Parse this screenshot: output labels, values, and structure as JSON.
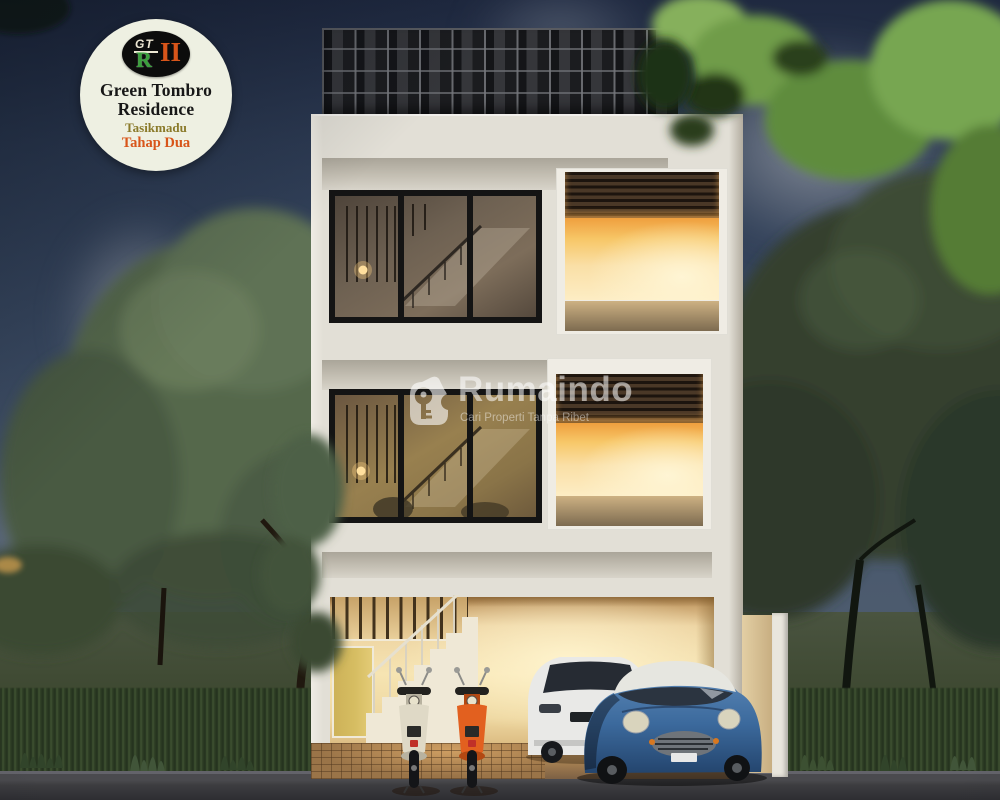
{
  "badge": {
    "logo_top": "GT",
    "logo_main": "R",
    "logo_numeral": "II",
    "title_line1": "Green Tombro",
    "title_line2": "Residence",
    "location": "Tasikmadu",
    "phase": "Tahap Dua"
  },
  "watermark": {
    "brand": "Rumaindo",
    "tagline": "Cari Properti Tanpa Ribet"
  },
  "palette": {
    "sky_top": "#1f2940",
    "sky_bottom": "#55626f",
    "facade": "#e2dfd6",
    "glow": "#f7c768",
    "louver": "#4a3827",
    "window_frame": "#141414",
    "door": "#d6bd62",
    "road": "#3d3d40",
    "grass": "#2f4026",
    "tree_left": "#55684c",
    "tree_right": "#34412e",
    "mini_blue": "#3c6a9d",
    "suv_white": "#e9e9e7",
    "scooter_cream": "#dfd9c6",
    "scooter_orange": "#e2601f",
    "badge_bg": "#eef0e2",
    "badge_green": "#3aa03c",
    "badge_orange": "#d8551a",
    "badge_olive": "#8a7a2a"
  }
}
